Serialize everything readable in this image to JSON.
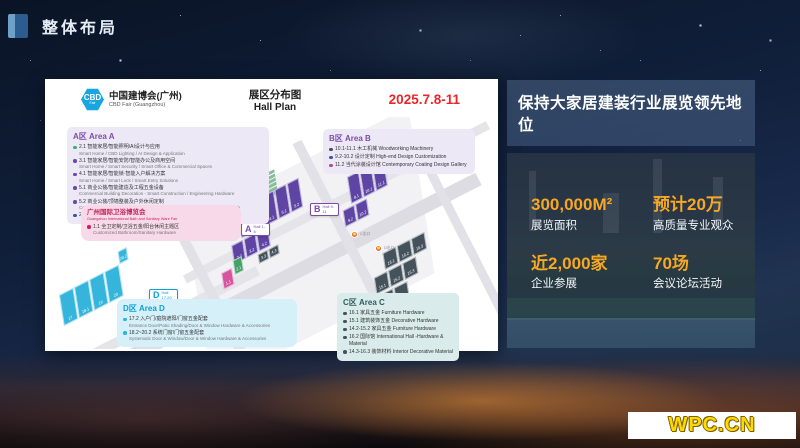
{
  "slide": {
    "header": {
      "title": "整体布局"
    },
    "footer_logo": "WPC.CN"
  },
  "hall_plan": {
    "brand": {
      "abbr": "CBD",
      "sub": "Fair",
      "name_cn": "中国建博会(广州)",
      "name_en": "CBD Fair (Guangzhou)"
    },
    "title_cn": "展区分布图",
    "title_en": "Hall Plan",
    "date": "2025.7.8-11",
    "area_a": {
      "title": "A区 Area A",
      "items": [
        {
          "dot": "#3baf6f",
          "cn": "2.1 智能家居/智能照明/AI设计与应用",
          "en": "Smart Home / CBD Lighting / AI Design & Application"
        },
        {
          "dot": "#6a4aab",
          "cn": "3.1 智能家居/智能安防/智能办公及商用空间",
          "en": "Smart Home / Smart Security / Smart Office & Commercial Spaces"
        },
        {
          "dot": "#6a4aab",
          "cn": "4.1 智能家居/智能锁·智能入户解决方案",
          "en": "Smart Home / Smart Lock / Smart Entry Solutions"
        },
        {
          "dot": "#6a4aab",
          "cn": "5.1 商业公装/智能建造及工程五金设备",
          "en": "Commercial Building Decoration - Smart Construction / Engineering Hardware"
        },
        {
          "dot": "#6a4aab",
          "cn": "5.2 商业公装/顶墙整装及户外休闲定制",
          "en": "Commercial Building Decoration - Ceiling & Wall / Outdoor & Recreation Lifestyle"
        },
        {
          "dot": "#3f51b5",
          "cn": "2.2-4.2 整体定制 Whole House Customisation",
          "en": ""
        }
      ]
    },
    "area_b": {
      "title": "B区 Area B",
      "items": [
        {
          "dot": "#44525c",
          "cn": "10.1-11.1 木工机械 Woodworking Machinery",
          "en": ""
        },
        {
          "dot": "#3f51b5",
          "cn": "9.2-10.2 设计定制 High-end Design Customization",
          "en": ""
        },
        {
          "dot": "#b0499c",
          "cn": "11.2 当代涂装设计馆 Contemporary Coating Design Gallery",
          "en": ""
        }
      ]
    },
    "area_c": {
      "title": "C区 Area C",
      "items": [
        {
          "dot": "#44525c",
          "cn": "16.1 家具五金 Furniture Hardware",
          "en": ""
        },
        {
          "dot": "#44525c",
          "cn": "15.1 建筑装饰五金 Decorative Hardware",
          "en": ""
        },
        {
          "dot": "#44525c",
          "cn": "14.2-15.2 家具五金 Furniture Hardware",
          "en": ""
        },
        {
          "dot": "#44525c",
          "cn": "16.2 国际馆 International Hall -Hardware & Material",
          "en": ""
        },
        {
          "dot": "#44525c",
          "cn": "14.3-16.3 装饰材料 Interior Decorative Material",
          "en": ""
        }
      ]
    },
    "area_d": {
      "title": "D区 Area D",
      "items": [
        {
          "dot": "#29b6d8",
          "cn": "17.2 入户门/庭院遮阳/门窗五金配套",
          "en": "Entrance Door/Patio Shading/Door & Window Hardware & Accessories"
        },
        {
          "dot": "#29b6d8",
          "cn": "18.2~20.2 系统门窗/门窗五金配套",
          "en": "Systematic Door & Window/Door & Window Hardware & Accessories"
        }
      ]
    },
    "sanitary": {
      "title_cn": "广州国际卫浴博览会",
      "title_en": "Guangzhou International Bath and Sanitary Ware Fair",
      "items": [
        {
          "dot": "#d81b60",
          "cn": "1.1 全卫定制/卫浴五金/阳台休闲主题区",
          "en": "Customized Bathroom/Sanitary Hardware"
        }
      ]
    },
    "map": {
      "badges": [
        {
          "letter": "A",
          "hall": "Hall 1-5"
        },
        {
          "letter": "B",
          "hall": "Hall 9-11"
        },
        {
          "letter": "C",
          "hall": "Hall 14-16"
        },
        {
          "letter": "D",
          "hall": "Hall 17-20"
        }
      ],
      "gates": [
        {
          "label": "A出口"
        },
        {
          "label": "B出口"
        },
        {
          "label": "C出口"
        },
        {
          "label": "D出口"
        },
        {
          "label": ""
        }
      ],
      "tiles": {
        "a_row1": [
          "2.1",
          "3.1",
          "4.1",
          "5.1",
          "5.2"
        ],
        "a_row2": [
          "2.2",
          "3.2",
          "4.2"
        ],
        "a_small": [
          "3.3",
          "4.3"
        ],
        "a_pink": "1.1",
        "a_green": "2.1",
        "b_row1": [
          "9.1",
          "10.1",
          "11.1"
        ],
        "b_row2": [
          "9.2",
          "10.2"
        ],
        "b_magenta": "11.2",
        "c_row1": [
          "16.1",
          "16.2",
          "16.3"
        ],
        "c_row2": [
          "15.1",
          "15.2",
          "15.3"
        ],
        "c_row3": [
          "14.1",
          "14.2",
          "14.3"
        ],
        "d_row": [
          "17",
          "18.1",
          "19",
          "20"
        ],
        "d_small": "20.2"
      },
      "colors": {
        "purple": "#5e44a3",
        "magenta": "#b0499c",
        "pink": "#d5569e",
        "green": "#46a06c",
        "cyan": "#35b5dc",
        "slate": "#44525c",
        "road": "#dcdce2"
      }
    }
  },
  "right_panel": {
    "title": "保持大家居建装行业展览领先地位",
    "accent_color": "#f7a823",
    "date_color": "#e8262a",
    "stats": [
      {
        "value": "300,000M²",
        "label": "展览面积"
      },
      {
        "value": "预计20万",
        "label": "高质量专业观众"
      },
      {
        "value": "近2,000家",
        "label": "企业参展"
      },
      {
        "value": "70场",
        "label": "会议论坛活动"
      }
    ]
  }
}
